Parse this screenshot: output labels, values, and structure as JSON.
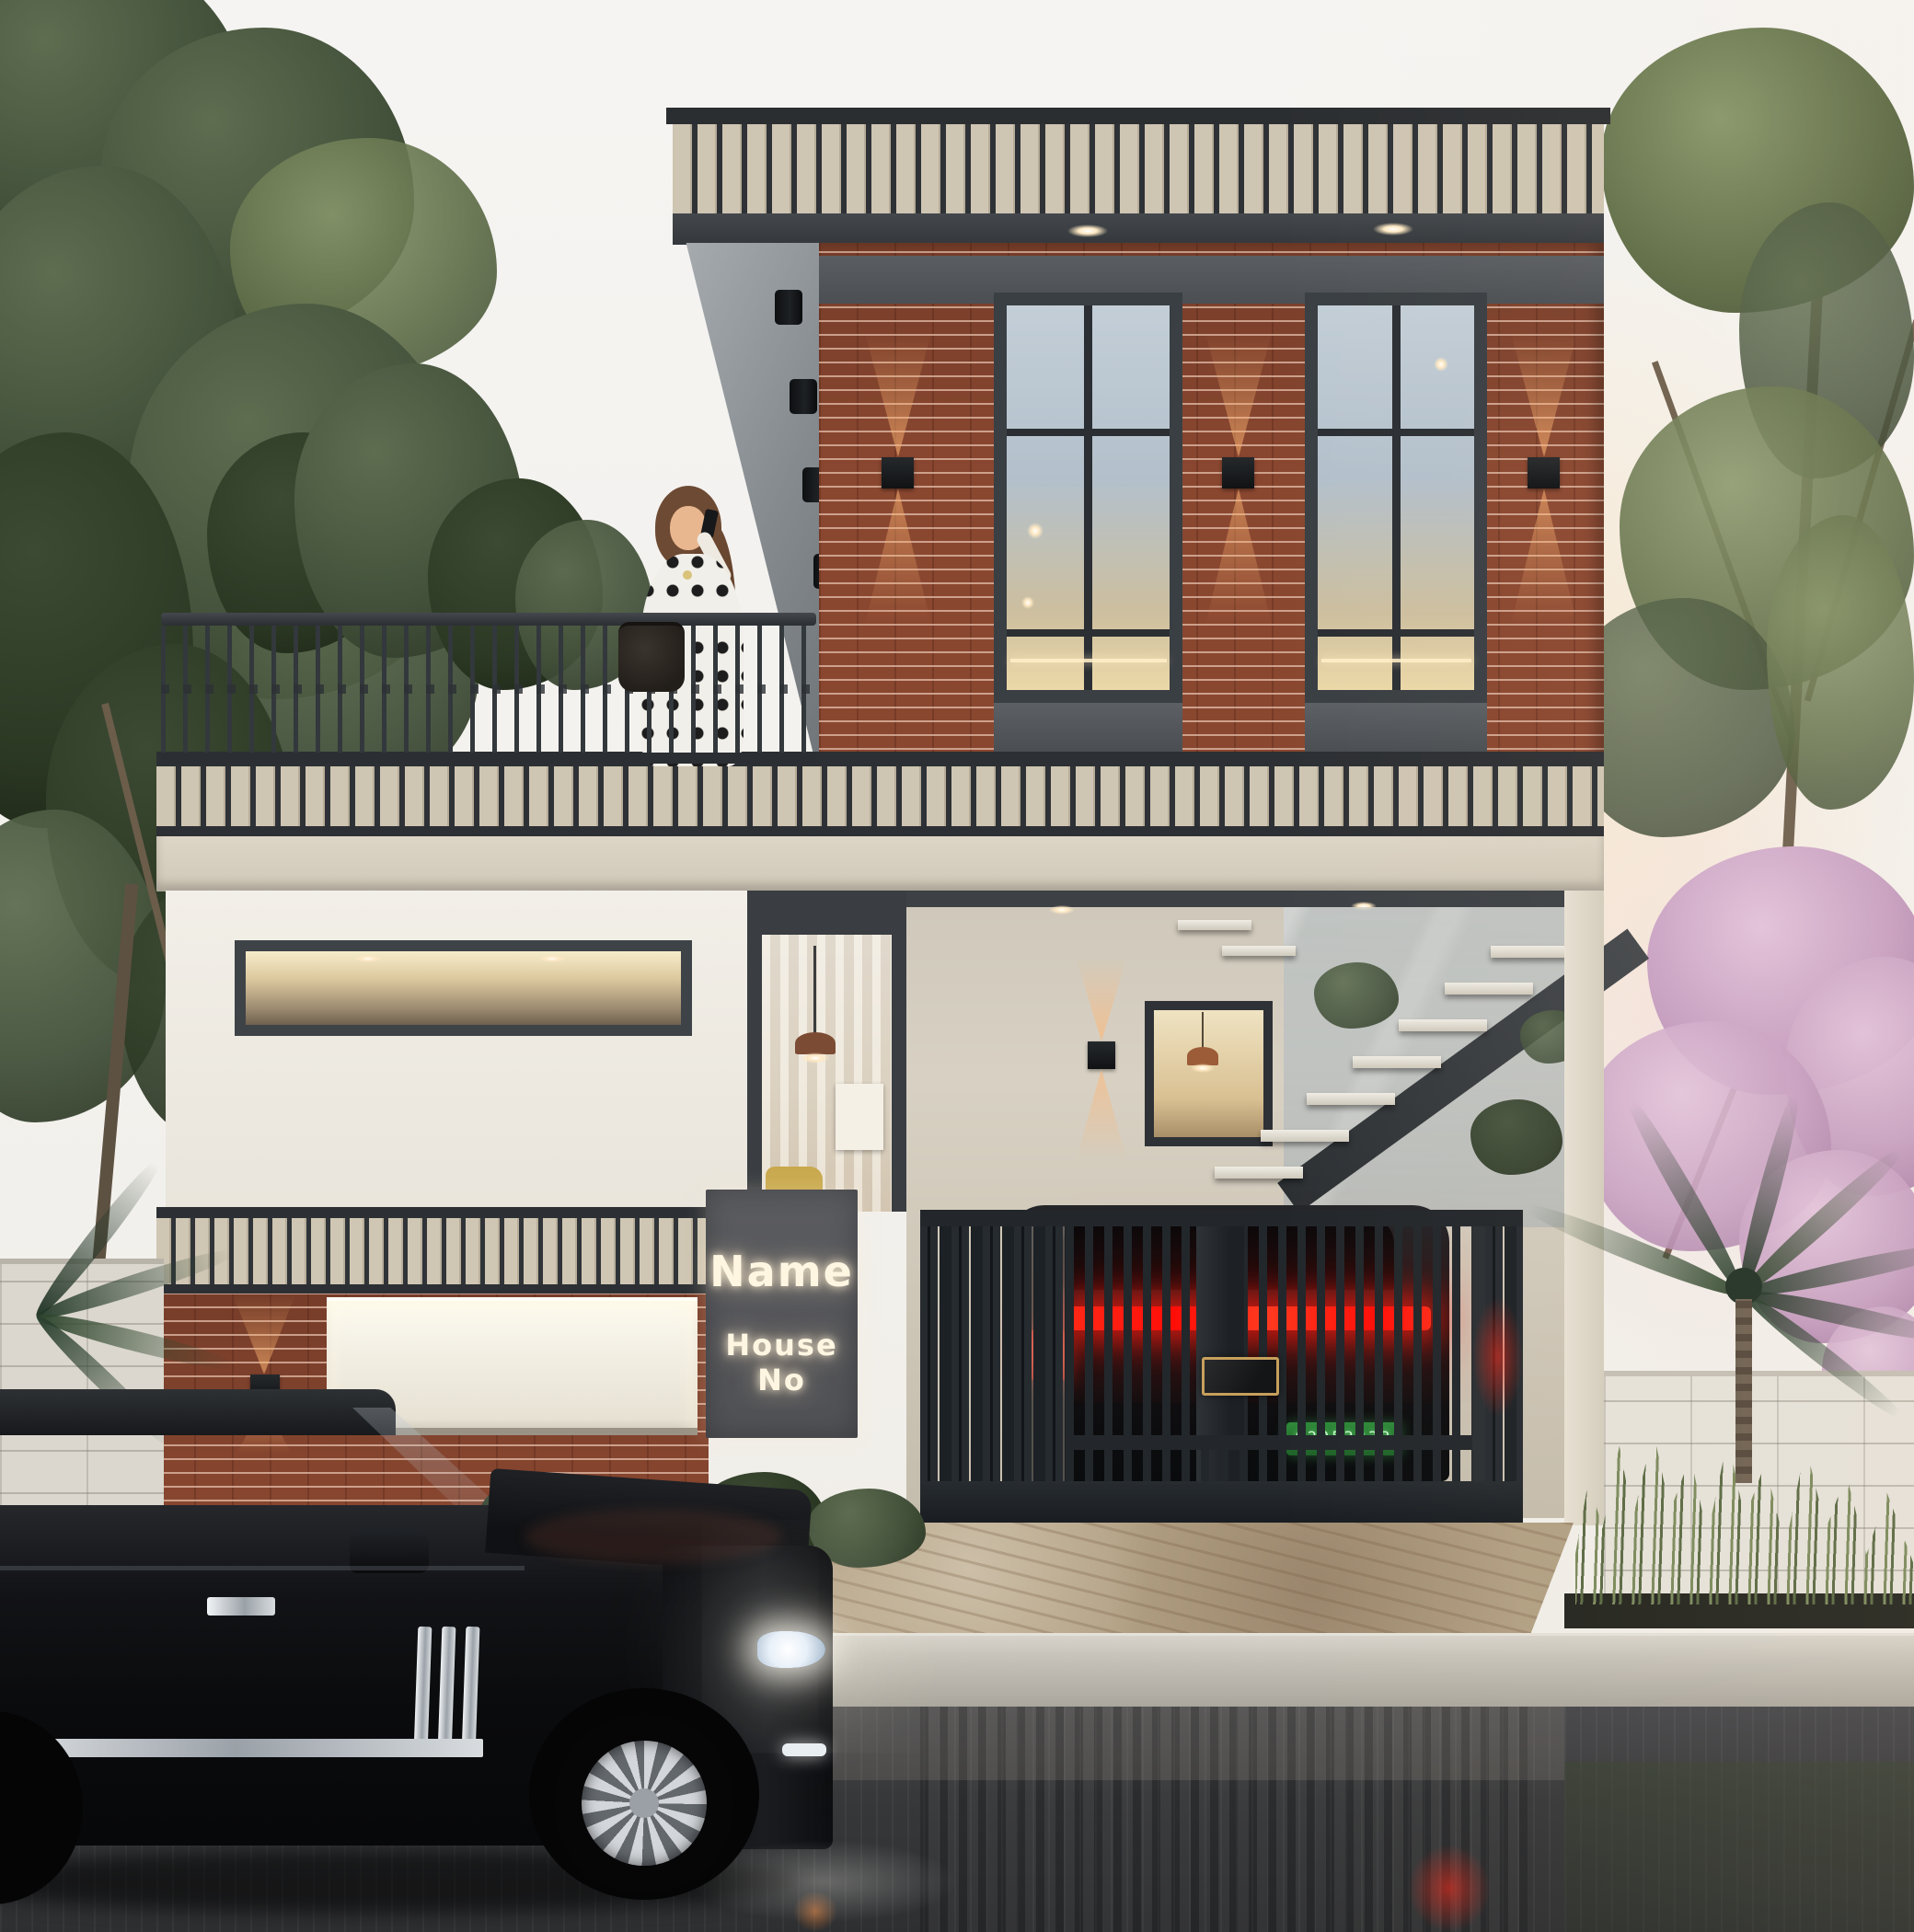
{
  "scene": {
    "type": "architectural_exterior_render",
    "time_of_day": "dusk",
    "description": "Modern two-storey brick-and-render house with roof terrace, woman on phone at balcony, glowing name sign, gated car porch with red tail-light glow, black SUV on wet street",
    "signboard": {
      "line1": "Name",
      "line2": "House No"
    },
    "license_plate": {
      "text": "62053333"
    },
    "elements": [
      "left-eucalyptus-tree",
      "roof-terrace-railing",
      "woman-on-phone",
      "handbag",
      "terrace-plants",
      "parapet-slat-band",
      "angled-soffit",
      "cylinder-downlights",
      "brick-facade",
      "grid-windows",
      "up-down-wall-sconces",
      "strip-window",
      "glass-entry-window",
      "floating-staircase",
      "interior-window",
      "house-sign",
      "garage-door-panel",
      "ornamental-gate",
      "car-behind-gate",
      "gold-plaque",
      "stone-plinth",
      "street-curb",
      "wet-road-reflections",
      "black-suv",
      "pink-blossom-tree",
      "green-tree",
      "palm-plants",
      "ornamental-grasses",
      "compound-walls"
    ],
    "colors": {
      "sky": "#f4f3f1",
      "sunset_glow": "#f6e3cc",
      "charcoal_trim": "#3c4044",
      "slat_beige": "#cec5b2",
      "brick": "#8a4730",
      "white_wall": "#efece5",
      "beige_beam": "#d8d0c1",
      "window_glass": "#b7c4cf",
      "warm_light": "#ffc98f",
      "sign_panel": "#56575b",
      "sign_text": "#fff6e2",
      "gate_metal": "#23282c",
      "tail_light_red": "#ff1410",
      "plate_green": "#2e7d36",
      "stone_plinth": "#b1a084",
      "curb": "#c9c5bc",
      "road": "#38393b",
      "suv_black": "#0b0c0e",
      "foliage_green": "#4c5a40",
      "blossom_pink": "#c99fc5",
      "palm_green": "#2f4530"
    }
  }
}
